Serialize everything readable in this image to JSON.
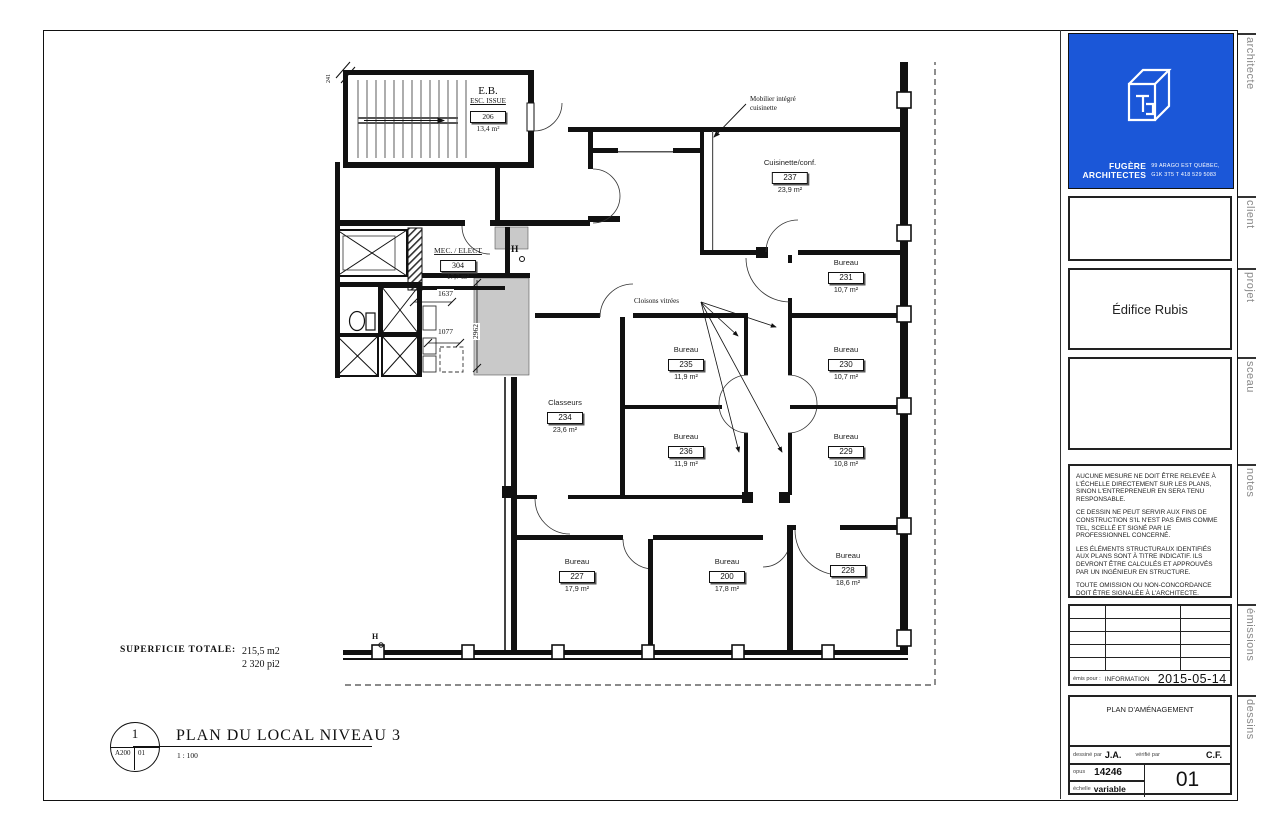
{
  "title_block": {
    "side_labels": [
      "architecte",
      "client",
      "projet",
      "sceau",
      "notes",
      "émissions",
      "dessins"
    ],
    "logo": {
      "firm_line1": "FUGÈRE",
      "firm_line2": "ARCHITECTES",
      "address_line1": "99 ARAGO EST QUÉBEC,",
      "address_line2": "G1K 3T5 T 418 529 5083"
    },
    "project_name": "Édifice Rubis",
    "notes": [
      "AUCUNE MESURE NE DOIT ÊTRE RELEVÉE À L'ÉCHELLE DIRECTEMENT SUR LES PLANS, SINON L'ENTREPRENEUR EN SERA TENU RESPONSABLE.",
      "CE DESSIN NE PEUT SERVIR AUX FINS DE CONSTRUCTION S'IL N'EST PAS ÉMIS COMME TEL, SCELLÉ ET SIGNÉ PAR LE PROFESSIONNEL CONCERNÉ.",
      "LES ÉLÉMENTS STRUCTURAUX IDENTIFIÉS AUX PLANS SONT À TITRE INDICATIF. ILS DEVRONT ÊTRE CALCULÉS ET APPROUVÉS PAR UN INGÉNIEUR EN STRUCTURE.",
      "TOUTE OMISSION OU NON-CONCORDANCE DOIT ÊTRE SIGNALÉE À L'ARCHITECTE."
    ],
    "emissions": {
      "emis_pour_label": "émis pour :",
      "emis_pour_value": "INFORMATION",
      "date": "2015-05-14"
    },
    "dessins": {
      "sheet_title": "PLAN D'AMÉNAGEMENT",
      "drawn_label": "dessiné par",
      "drawn_value": "J.A.",
      "verified_label": "vérifié par",
      "verified_value": "C.F.",
      "opus_label": "opus",
      "opus_value": "14246",
      "scale_label": "échelle",
      "scale_value": "variable",
      "sheet_number": "01"
    },
    "accent_color": "#1b57d8"
  },
  "plan": {
    "rooms": [
      {
        "name": "Cuisinette/conf.",
        "number": "237",
        "area": "23,9 m²",
        "x": 790,
        "y": 158
      },
      {
        "name": "Bureau",
        "number": "231",
        "area": "10,7 m²",
        "x": 846,
        "y": 258
      },
      {
        "name": "Bureau",
        "number": "235",
        "area": "11,9 m²",
        "x": 686,
        "y": 345
      },
      {
        "name": "Bureau",
        "number": "230",
        "area": "10,7 m²",
        "x": 846,
        "y": 345
      },
      {
        "name": "Classeurs",
        "number": "234",
        "area": "23,6 m²",
        "x": 565,
        "y": 398
      },
      {
        "name": "Bureau",
        "number": "236",
        "area": "11,9 m²",
        "x": 686,
        "y": 432
      },
      {
        "name": "Bureau",
        "number": "229",
        "area": "10,8 m²",
        "x": 846,
        "y": 432
      },
      {
        "name": "Bureau",
        "number": "227",
        "area": "17,9 m²",
        "x": 577,
        "y": 557
      },
      {
        "name": "Bureau",
        "number": "200",
        "area": "17,8 m²",
        "x": 727,
        "y": 557
      },
      {
        "name": "Bureau",
        "number": "228",
        "area": "18,6 m²",
        "x": 848,
        "y": 551
      }
    ],
    "stair_room": {
      "label": "E.B.",
      "sublabel": "ESC. ISSUE",
      "number": "206",
      "area": "13,4 m²"
    },
    "mec_room": {
      "name": "MEC. / ELECT",
      "number": "304",
      "area": "17,7 m²"
    },
    "annotations": {
      "mobilier_line1": "Mobilier intégré",
      "mobilier_line2": "cuisinette",
      "cloisons": "Cloisons vitrées"
    },
    "dimensions": {
      "d1": "1637",
      "d2": "1077",
      "d3": "2962",
      "d4": "241"
    },
    "symbols": {
      "hose_bibb": "H"
    },
    "summary": {
      "label": "SUPERFICIE TOTALE:",
      "value_m2": "215,5 m2",
      "value_pi2": "2 320 pi2"
    },
    "title_bar": {
      "detail_number": "1",
      "sheet_ref": "A200",
      "sheet_sub": "01",
      "title": "PLAN DU LOCAL NIVEAU 3",
      "scale": "1 : 100"
    }
  }
}
